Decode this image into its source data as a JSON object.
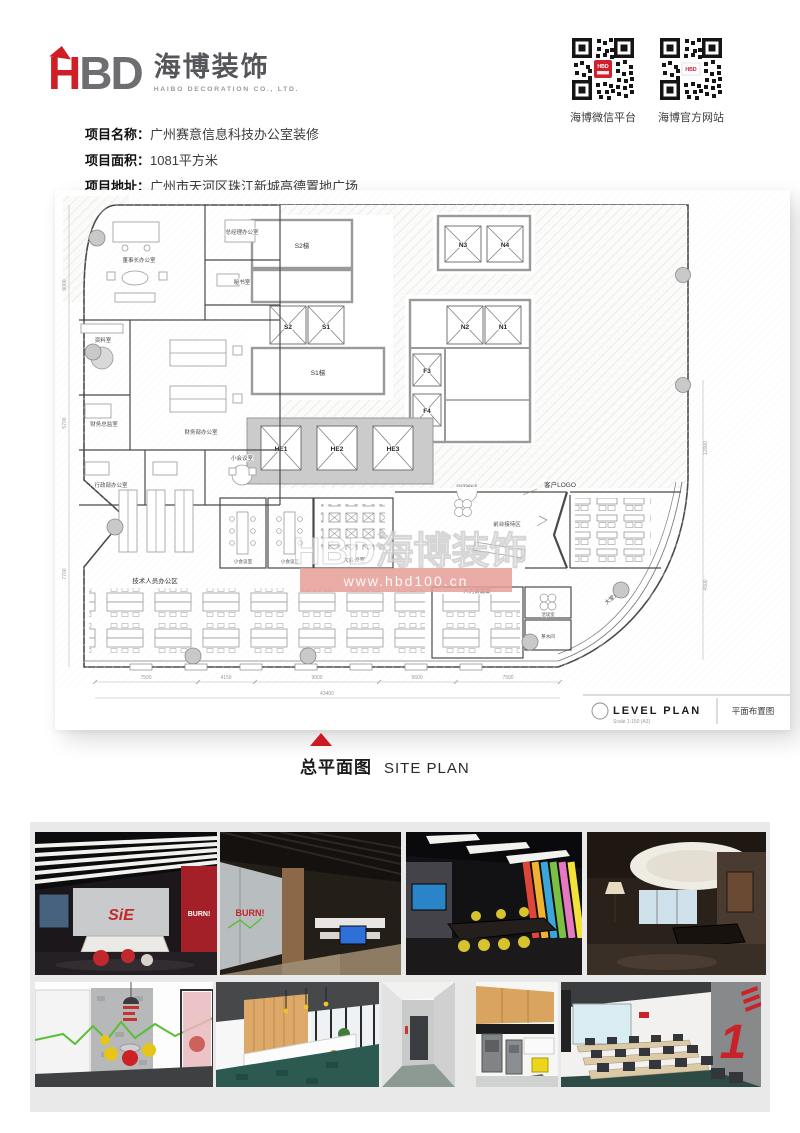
{
  "header": {
    "logo": {
      "h": "H",
      "bd": "BD",
      "cn": "海博装饰",
      "en": "HAIBO DECORATION CO., LTD."
    },
    "qr_codes": [
      {
        "label": "海博微信平台",
        "badge": "HBD"
      },
      {
        "label": "海博官方网站",
        "badge": "HBD"
      }
    ]
  },
  "project": {
    "rows": [
      {
        "label": "项目名称：",
        "value": "广州赛意信息科技办公室装修"
      },
      {
        "label": "项目面积：",
        "value": "1081平方米"
      },
      {
        "label": "项目地址：",
        "value": "广州市天河区珠江新城高德置地广场"
      }
    ]
  },
  "plan": {
    "rooms": {
      "chairman": "董事长办公室",
      "gm": "总经理办公室",
      "secretary": "秘书室",
      "archive": "资料室",
      "finance": "财务部办公室",
      "finance_director": "财务总监室",
      "admin": "行政部办公室",
      "meeting_small": "小会议室",
      "meeting_small2": "小会议室",
      "meeting_small3": "小会议室",
      "meeting_large": "大会议室",
      "tech": "技术人员办公区",
      "reception": "前台接待区",
      "hr": "人力资源部",
      "negotiation": "洽谈室",
      "pantry": "茶水间",
      "s2": "S2梯",
      "s1": "S1梯"
    },
    "labels": {
      "client_logo": "客户LOGO",
      "entrance": "ENTRANCE",
      "lobby": "大堂走廊"
    },
    "elevators": [
      "S2",
      "S1",
      "N3",
      "N4",
      "N2",
      "N1",
      "F3",
      "F4",
      "HE1",
      "HE2",
      "HE3"
    ],
    "watermark": {
      "brand": "HBD海博装饰",
      "url": "www.hbd100.cn"
    },
    "title_block": {
      "title": "LEVEL  PLAN",
      "scale": "Scale  1:150 (A3)",
      "cn": "平面布置图"
    },
    "dims": {
      "bottom": [
        "7500",
        "4150",
        "9000",
        "5600",
        "7500"
      ],
      "bottom_total": "43400",
      "left": [
        "9000",
        "5700",
        "7700"
      ],
      "right": [
        "12000",
        "4500"
      ]
    }
  },
  "section_title": {
    "cn": "总平面图",
    "en": "SITE PLAN"
  },
  "gallery": {
    "overlays": {
      "p1": "SiE",
      "p1b": "BURN!",
      "p2": "BURN!",
      "p9": "1"
    }
  }
}
